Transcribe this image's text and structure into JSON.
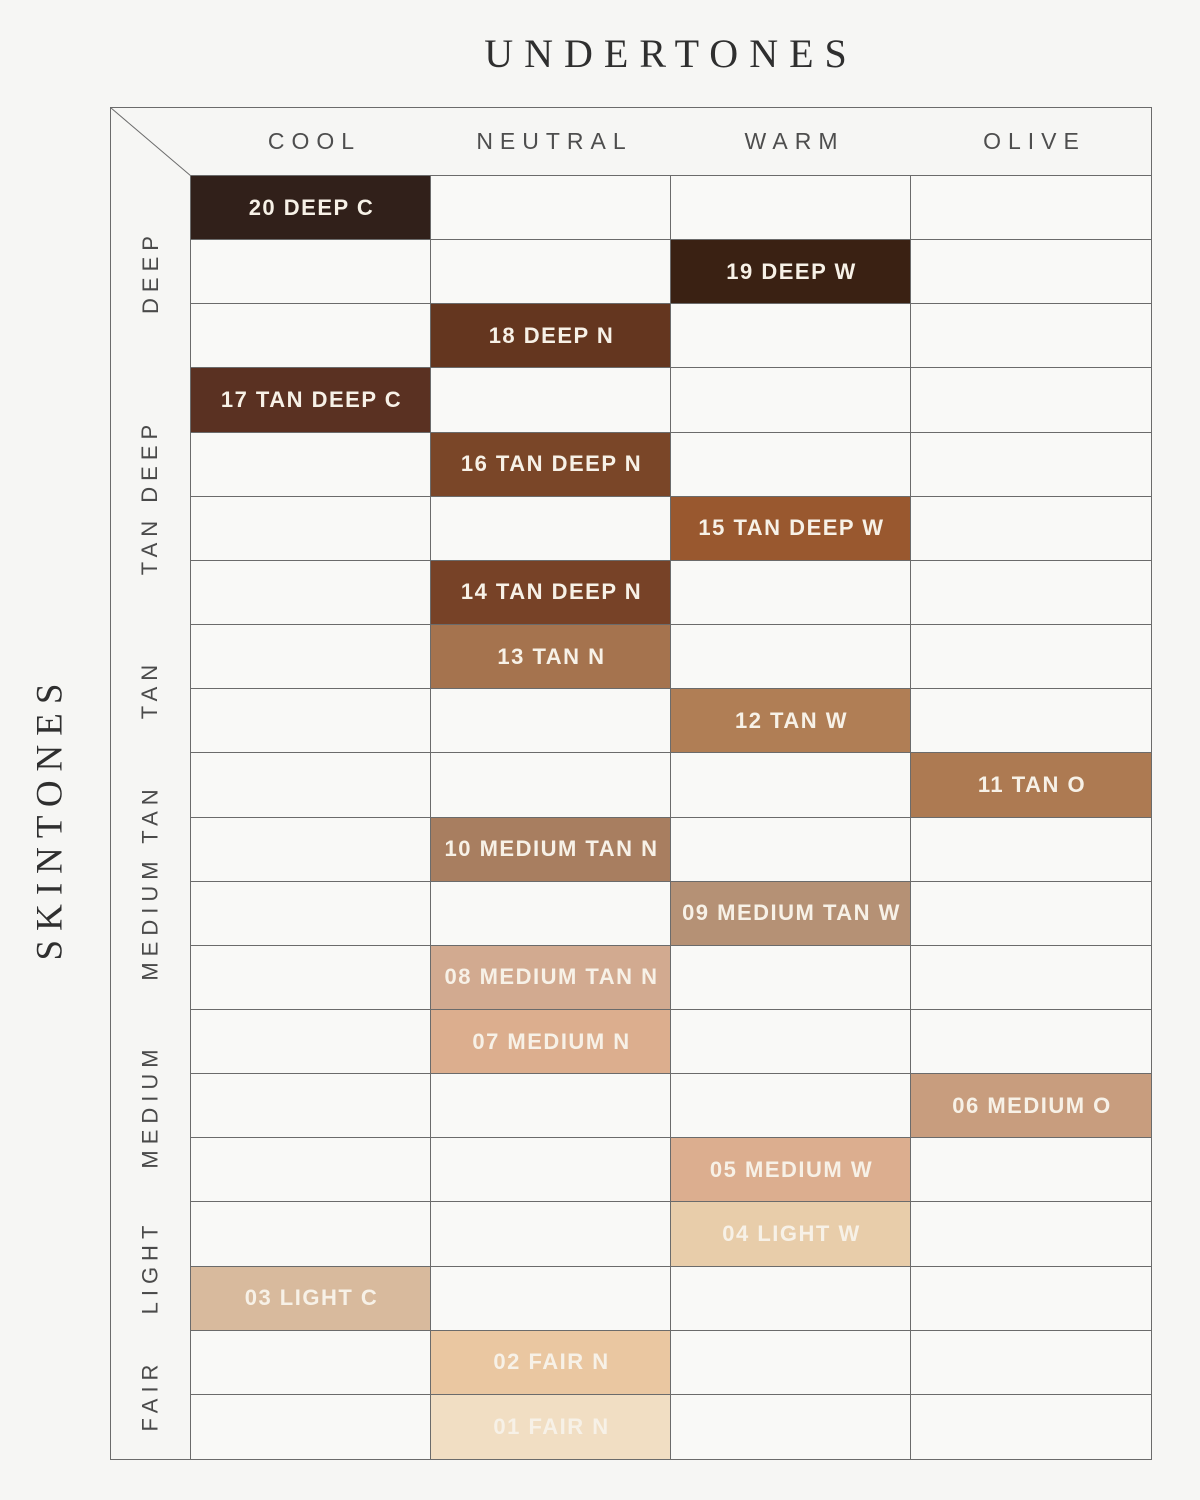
{
  "chart_data": {
    "type": "heatmap",
    "title": "UNDERTONES",
    "ylabel": "SKINTONES",
    "columns": [
      "COOL",
      "NEUTRAL",
      "WARM",
      "OLIVE"
    ],
    "row_groups": [
      {
        "label": "DEEP",
        "row_span": 3
      },
      {
        "label": "TAN DEEP",
        "row_span": 4
      },
      {
        "label": "TAN",
        "row_span": 2
      },
      {
        "label": "MEDIUM TAN",
        "row_span": 4
      },
      {
        "label": "MEDIUM",
        "row_span": 3
      },
      {
        "label": "LIGHT",
        "row_span": 2
      },
      {
        "label": "FAIR",
        "row_span": 2
      }
    ],
    "rows": 20,
    "shades": [
      {
        "row": 1,
        "col": 0,
        "label": "20 DEEP C",
        "undertone": "COOL",
        "skintone": "DEEP",
        "color": "#31201a"
      },
      {
        "row": 2,
        "col": 2,
        "label": "19 DEEP W",
        "undertone": "WARM",
        "skintone": "DEEP",
        "color": "#3a2113"
      },
      {
        "row": 3,
        "col": 1,
        "label": "18 DEEP N",
        "undertone": "NEUTRAL",
        "skintone": "DEEP",
        "color": "#64361f"
      },
      {
        "row": 4,
        "col": 0,
        "label": "17 TAN DEEP C",
        "undertone": "COOL",
        "skintone": "TAN DEEP",
        "color": "#5a3122"
      },
      {
        "row": 5,
        "col": 1,
        "label": "16 TAN DEEP N",
        "undertone": "NEUTRAL",
        "skintone": "TAN DEEP",
        "color": "#7a4628"
      },
      {
        "row": 6,
        "col": 2,
        "label": "15 TAN DEEP W",
        "undertone": "WARM",
        "skintone": "TAN DEEP",
        "color": "#99582f"
      },
      {
        "row": 7,
        "col": 1,
        "label": "14 TAN DEEP N",
        "undertone": "NEUTRAL",
        "skintone": "TAN DEEP",
        "color": "#774227"
      },
      {
        "row": 8,
        "col": 1,
        "label": "13 TAN N",
        "undertone": "NEUTRAL",
        "skintone": "TAN",
        "color": "#a5734e"
      },
      {
        "row": 9,
        "col": 2,
        "label": "12 TAN W",
        "undertone": "WARM",
        "skintone": "TAN",
        "color": "#b07e55"
      },
      {
        "row": 10,
        "col": 3,
        "label": "11 TAN O",
        "undertone": "OLIVE",
        "skintone": "MEDIUM TAN",
        "color": "#ad7a52"
      },
      {
        "row": 11,
        "col": 1,
        "label": "10 MEDIUM TAN N",
        "undertone": "NEUTRAL",
        "skintone": "MEDIUM TAN",
        "color": "#a87e60"
      },
      {
        "row": 12,
        "col": 2,
        "label": "09 MEDIUM TAN W",
        "undertone": "WARM",
        "skintone": "MEDIUM TAN",
        "color": "#b59175"
      },
      {
        "row": 13,
        "col": 1,
        "label": "08 MEDIUM TAN N",
        "undertone": "NEUTRAL",
        "skintone": "MEDIUM TAN",
        "color": "#d2aa90"
      },
      {
        "row": 14,
        "col": 1,
        "label": "07 MEDIUM N",
        "undertone": "NEUTRAL",
        "skintone": "MEDIUM",
        "color": "#dcae8e"
      },
      {
        "row": 15,
        "col": 3,
        "label": "06 MEDIUM O",
        "undertone": "OLIVE",
        "skintone": "MEDIUM",
        "color": "#c89d7e"
      },
      {
        "row": 16,
        "col": 2,
        "label": "05 MEDIUM W",
        "undertone": "WARM",
        "skintone": "MEDIUM",
        "color": "#dcae8f"
      },
      {
        "row": 17,
        "col": 2,
        "label": "04 LIGHT W",
        "undertone": "WARM",
        "skintone": "LIGHT",
        "color": "#e8cdaa"
      },
      {
        "row": 18,
        "col": 0,
        "label": "03 LIGHT C",
        "undertone": "COOL",
        "skintone": "LIGHT",
        "color": "#d8ba9d"
      },
      {
        "row": 19,
        "col": 1,
        "label": "02 FAIR N",
        "undertone": "NEUTRAL",
        "skintone": "FAIR",
        "color": "#eac7a1"
      },
      {
        "row": 20,
        "col": 1,
        "label": "01 FAIR N",
        "undertone": "NEUTRAL",
        "skintone": "FAIR",
        "color": "#f1dec3"
      }
    ]
  },
  "colors": {
    "background": "#f6f6f4",
    "cell_background": "#f9f9f7",
    "grid_line": "#6b6b6b",
    "title_text": "#2f2f2f",
    "header_text": "#4e4e4e",
    "group_label_text": "#4a4a4a",
    "swatch_label_text": "#f7f1e7"
  }
}
